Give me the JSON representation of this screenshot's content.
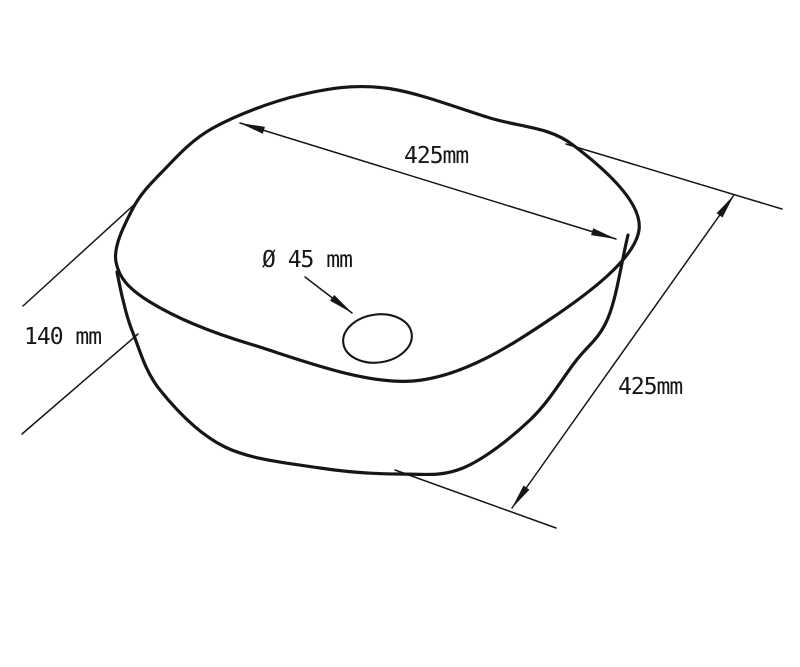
{
  "figure": {
    "subject": "Rounded-square vessel washbasin shown in perspective as a technical line drawing",
    "background_color": "#ffffff",
    "line_color": "#161616"
  },
  "labels": {
    "top_width": "425mm",
    "right_depth": "425mm",
    "left_height": "140 mm",
    "drain_diameter": "Ø 45 mm"
  },
  "dimensions": [
    {
      "value": "425mm",
      "location": "across basin opening, upper dimension arrow"
    },
    {
      "value": "425mm",
      "location": "right side, front-to-back depth dimension arrow"
    },
    {
      "value": "140 mm",
      "location": "left side, basin height between extension lines"
    },
    {
      "value": "Ø 45 mm",
      "location": "drain hole diameter callout with leader arrow"
    }
  ]
}
